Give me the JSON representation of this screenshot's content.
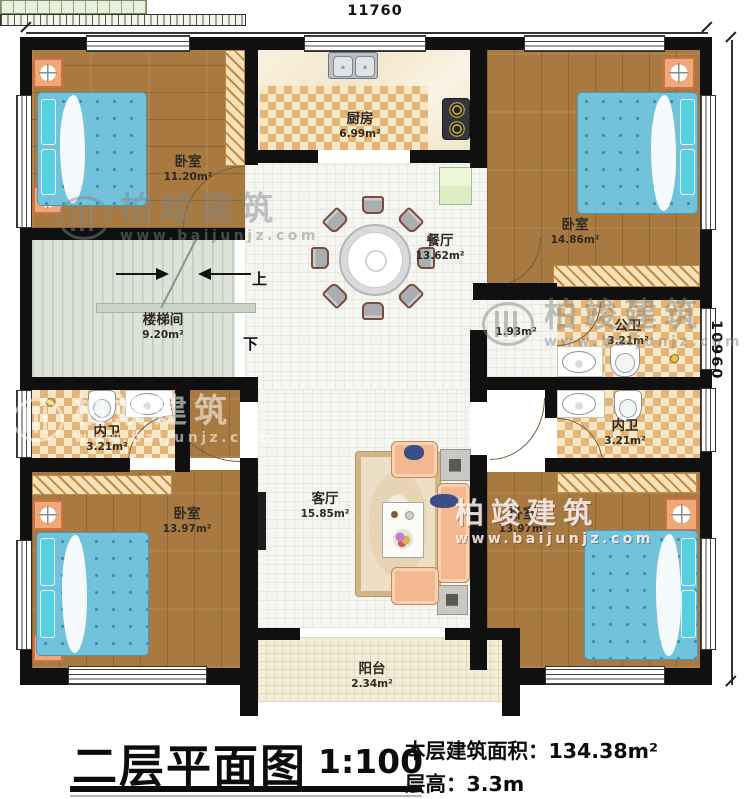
{
  "dimensions": {
    "top": "11760",
    "right": "10960"
  },
  "rooms": [
    {
      "id": "bedroom-top-left",
      "label": "卧室",
      "area": "11.20m²"
    },
    {
      "id": "kitchen",
      "label": "厨房",
      "area": "6.99m²"
    },
    {
      "id": "bedroom-top-right",
      "label": "卧室",
      "area": "14.86m²"
    },
    {
      "id": "dining",
      "label": "餐厅",
      "area": "13.62m²"
    },
    {
      "id": "stairwell",
      "label": "楼梯间",
      "area": "9.20m²"
    },
    {
      "id": "hallway",
      "label": "",
      "area": "1.93m²"
    },
    {
      "id": "public-bath",
      "label": "公卫",
      "area": "3.21m²"
    },
    {
      "id": "ensuite-bath-right",
      "label": "内卫",
      "area": "3.21m²"
    },
    {
      "id": "ensuite-bath-left",
      "label": "内卫",
      "area": "3.21m²"
    },
    {
      "id": "bedroom-bottom-left",
      "label": "卧室",
      "area": "13.97m²"
    },
    {
      "id": "living",
      "label": "客厅",
      "area": "15.85m²"
    },
    {
      "id": "bedroom-bottom-right",
      "label": "卧室",
      "area": "13.97m²"
    },
    {
      "id": "balcony",
      "label": "阳台",
      "area": "2.34m²"
    }
  ],
  "stairs": {
    "up": "上",
    "down": "下"
  },
  "watermark": {
    "brand": "柏竣建筑",
    "url": "www.baijunjz.com"
  },
  "titleblock": {
    "title": "二层平面图",
    "scale": "1:100",
    "area_label": "本层建筑面积：",
    "area_value": "134.38m²",
    "height_label": "层高：",
    "height_value": "3.3m"
  }
}
